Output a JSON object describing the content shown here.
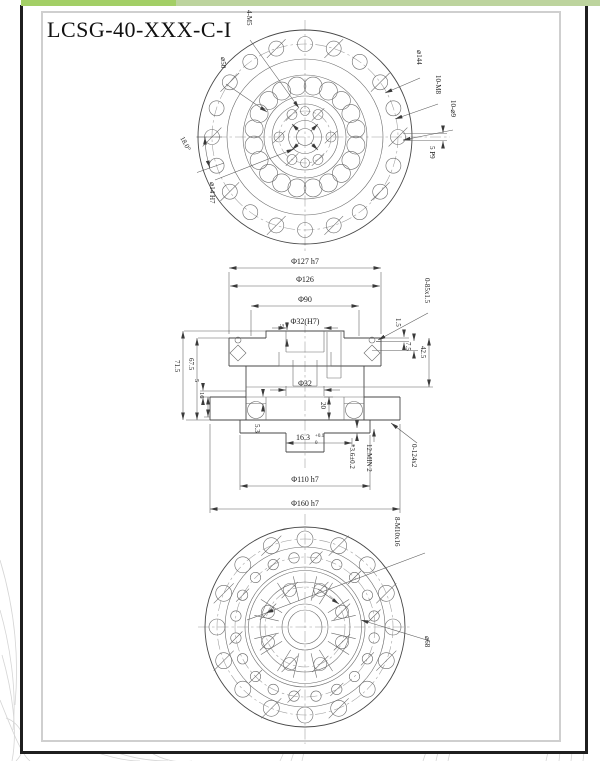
{
  "topbar": {
    "accent_left": "#a3cf66",
    "accent_right": "#bdd49e"
  },
  "sheet": {
    "title": "LCSG-40-XXX-C-I"
  },
  "top_view": {
    "d4m5": "4-M5",
    "d50": "⌀50",
    "d144": "⌀144",
    "d10m8": "10-M8",
    "d10d9": "10-⌀9",
    "key": "5 P9",
    "angle": "18.0°",
    "bore": "⌀14 H7"
  },
  "section": {
    "d127": "Φ127 h7",
    "d126": "Φ126",
    "d90": "Φ90",
    "d32h7": "Φ32(H7)",
    "boss5": "5",
    "oring_top": "0-85x1.5",
    "r15": "1.5",
    "r75": "7.5",
    "r425": "42.5",
    "l715": "71.5",
    "l675": "67.5",
    "l5": "5",
    "l16": "16",
    "d32": "Φ32",
    "v20": "20",
    "v53": "5.3",
    "v163": "16.3",
    "v163_tu": "+0.1",
    "v163_td": "0",
    "v36": "*3.6±0.2",
    "v12min": "12:MIN 2",
    "oring_bot": "0-124x2",
    "d110": "Φ110 h7",
    "d160": "Φ160 h7"
  },
  "bottom_view": {
    "d8m10": "8-M10x16",
    "d68": "⌀68"
  }
}
